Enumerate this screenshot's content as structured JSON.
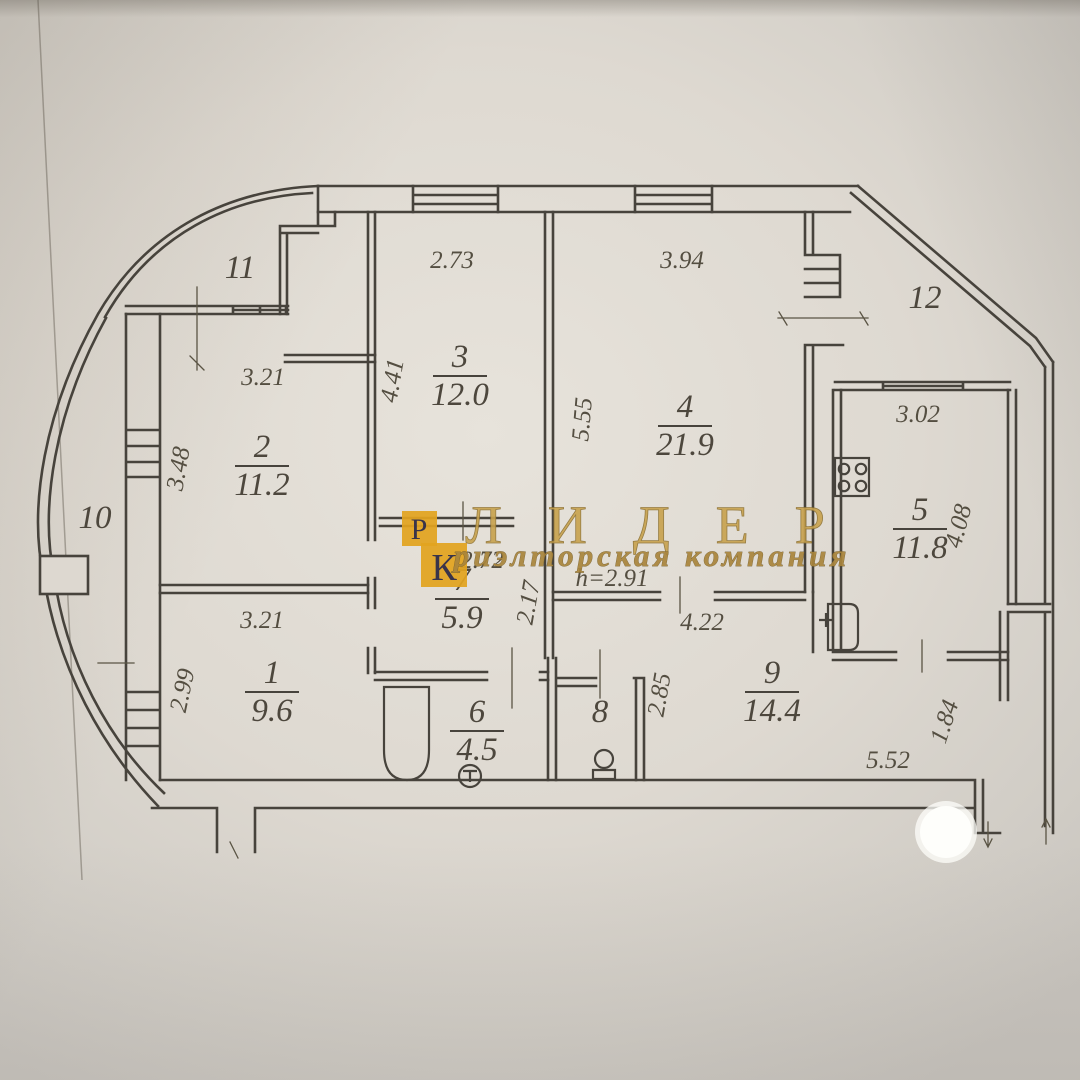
{
  "background": {
    "paper": "#ddd8d0",
    "ink": "#47433c"
  },
  "watermark": {
    "logo_letter_1": "Р",
    "logo_letter_2": "К",
    "brand": "ЛИДЕР",
    "tagline": "риэлторская компания",
    "gold": "#e2a41f"
  },
  "rooms": [
    {
      "number": "1",
      "area": "9.6",
      "x": 272,
      "y": 683
    },
    {
      "number": "2",
      "area": "11.2",
      "x": 262,
      "y": 457
    },
    {
      "number": "3",
      "area": "12.0",
      "x": 460,
      "y": 367
    },
    {
      "number": "4",
      "area": "21.9",
      "x": 685,
      "y": 417
    },
    {
      "number": "5",
      "area": "11.8",
      "x": 920,
      "y": 520
    },
    {
      "number": "6",
      "area": "4.5",
      "x": 477,
      "y": 722
    },
    {
      "number": "7",
      "area": "5.9",
      "x": 462,
      "y": 590
    },
    {
      "number": "8",
      "area": "",
      "x": 600,
      "y": 722
    },
    {
      "number": "9",
      "area": "14.4",
      "x": 772,
      "y": 683
    },
    {
      "number": "10",
      "area": "",
      "x": 95,
      "y": 528
    },
    {
      "number": "11",
      "area": "",
      "x": 240,
      "y": 278
    },
    {
      "number": "12",
      "area": "",
      "x": 925,
      "y": 308
    }
  ],
  "dimensions": [
    {
      "text": "2.73",
      "x": 452,
      "y": 268,
      "rot": 0
    },
    {
      "text": "3.94",
      "x": 682,
      "y": 268,
      "rot": 0
    },
    {
      "text": "3.21",
      "x": 263,
      "y": 385,
      "rot": 0
    },
    {
      "text": "3.48",
      "x": 186,
      "y": 470,
      "rot": -80
    },
    {
      "text": "4.41",
      "x": 400,
      "y": 382,
      "rot": -80
    },
    {
      "text": "5.55",
      "x": 590,
      "y": 420,
      "rot": -85
    },
    {
      "text": "3.02",
      "x": 918,
      "y": 422,
      "rot": 0
    },
    {
      "text": "4.08",
      "x": 966,
      "y": 528,
      "rot": -75
    },
    {
      "text": "2.99",
      "x": 190,
      "y": 692,
      "rot": -78
    },
    {
      "text": "3.21",
      "x": 262,
      "y": 628,
      "rot": 0
    },
    {
      "text": "2.17",
      "x": 536,
      "y": 604,
      "rot": -80
    },
    {
      "text": "2.72",
      "x": 482,
      "y": 568,
      "rot": 0
    },
    {
      "text": "h=2.91",
      "x": 612,
      "y": 586,
      "rot": 0
    },
    {
      "text": "4.22",
      "x": 702,
      "y": 630,
      "rot": 0
    },
    {
      "text": "2.85",
      "x": 667,
      "y": 696,
      "rot": -80
    },
    {
      "text": "5.52",
      "x": 888,
      "y": 768,
      "rot": 0
    },
    {
      "text": "1.84",
      "x": 952,
      "y": 724,
      "rot": -72
    }
  ],
  "fixtures": [
    "bathtub",
    "washbasin",
    "toilet",
    "stove",
    "kitchen-sink"
  ]
}
